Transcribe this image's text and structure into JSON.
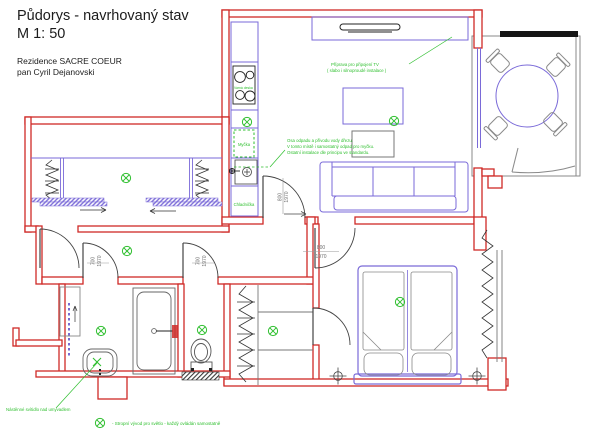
{
  "header": {
    "title": "Půdorys - navrhovaný stav",
    "scale": "M 1: 50",
    "client_line1": "Rezidence SACRE COEUR",
    "client_line2": "pan Cyril Dejanovski"
  },
  "annotations": {
    "tv_note_line1": "Příprava pro připojení TV",
    "tv_note_line2": "( slabo i silnoproudé instalace )",
    "sink_note_line1": "Osa odpadu a přívodu vody dřezu.",
    "sink_note_line2": "V tomto místě i samostatný odpad pro myčku.",
    "sink_note_line3": "Ostatní instalace dle principu ve standardu.",
    "basin_note": "Nástěnné svítidlo nad umyvadlem"
  },
  "legend": {
    "symbol": "ceiling-light-outlet",
    "text": "- Stropní vývod pro světlo - každý ovládán samostatně"
  },
  "room_labels": {
    "dishwasher": "Myčka",
    "fridge": "Chladnička",
    "cooktop": "Varná deska"
  },
  "dimensions": {
    "door_width_800": "800",
    "door_width_700": "700",
    "door_height_1970": "1970"
  },
  "colors": {
    "new_wall": "#cf2a27",
    "furniture": "#7a6ad8",
    "electrical": "#2fbf2f",
    "existing": "#8a8a8a",
    "dimension_text": "#6f6f6f"
  }
}
